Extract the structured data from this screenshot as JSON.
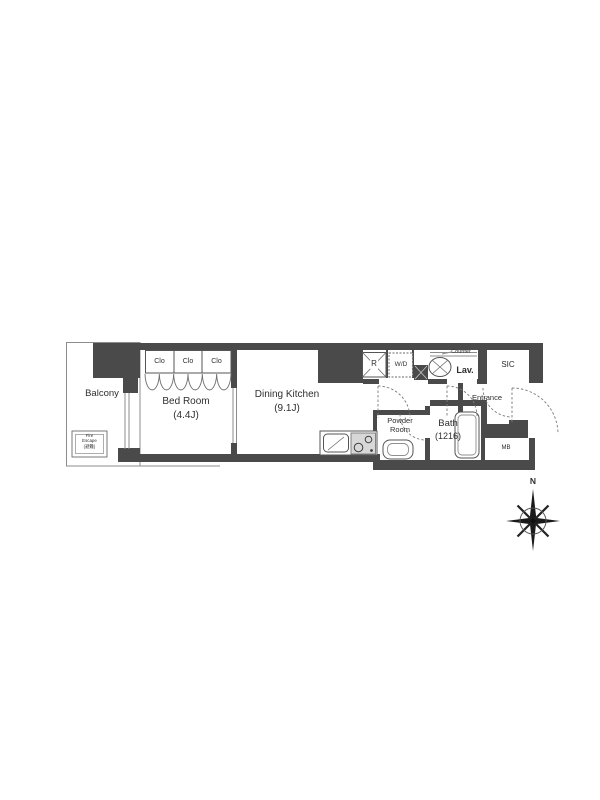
{
  "floor_plan": {
    "rooms": {
      "balcony": {
        "label": "Balcony"
      },
      "bed_room": {
        "label": "Bed Room",
        "size": "(4.4J)"
      },
      "dining_kitchen": {
        "label": "Dining Kitchen",
        "size": "(9.1J)"
      },
      "closets": [
        {
          "label": "Clo"
        },
        {
          "label": "Clo"
        },
        {
          "label": "Clo"
        }
      ],
      "refrigerator_space": {
        "label": "R"
      },
      "washer_dryer": {
        "label": "W/D"
      },
      "lavatory": {
        "label": "Lav.",
        "counter": "Counter"
      },
      "shoe_in_closet": {
        "label": "SIC"
      },
      "entrance": {
        "label": "Entrance"
      },
      "powder_room": {
        "line1": "Powder",
        "line2": "Room"
      },
      "bath": {
        "label": "Bath",
        "size": "(1216)"
      },
      "meter_box": {
        "label": "MB"
      },
      "fire_escape": {
        "line1": "Fire",
        "line2": "Escape",
        "line3": "(避難)"
      }
    },
    "compass": {
      "north": "N"
    },
    "colors": {
      "wall": "#4a4a4a",
      "line": "#8c8c8c",
      "line_dark": "#555555",
      "text": "#2e2e2e",
      "stove": "#d8d8d8",
      "door_arc": "#7a7a7a",
      "background": "#ffffff"
    }
  }
}
